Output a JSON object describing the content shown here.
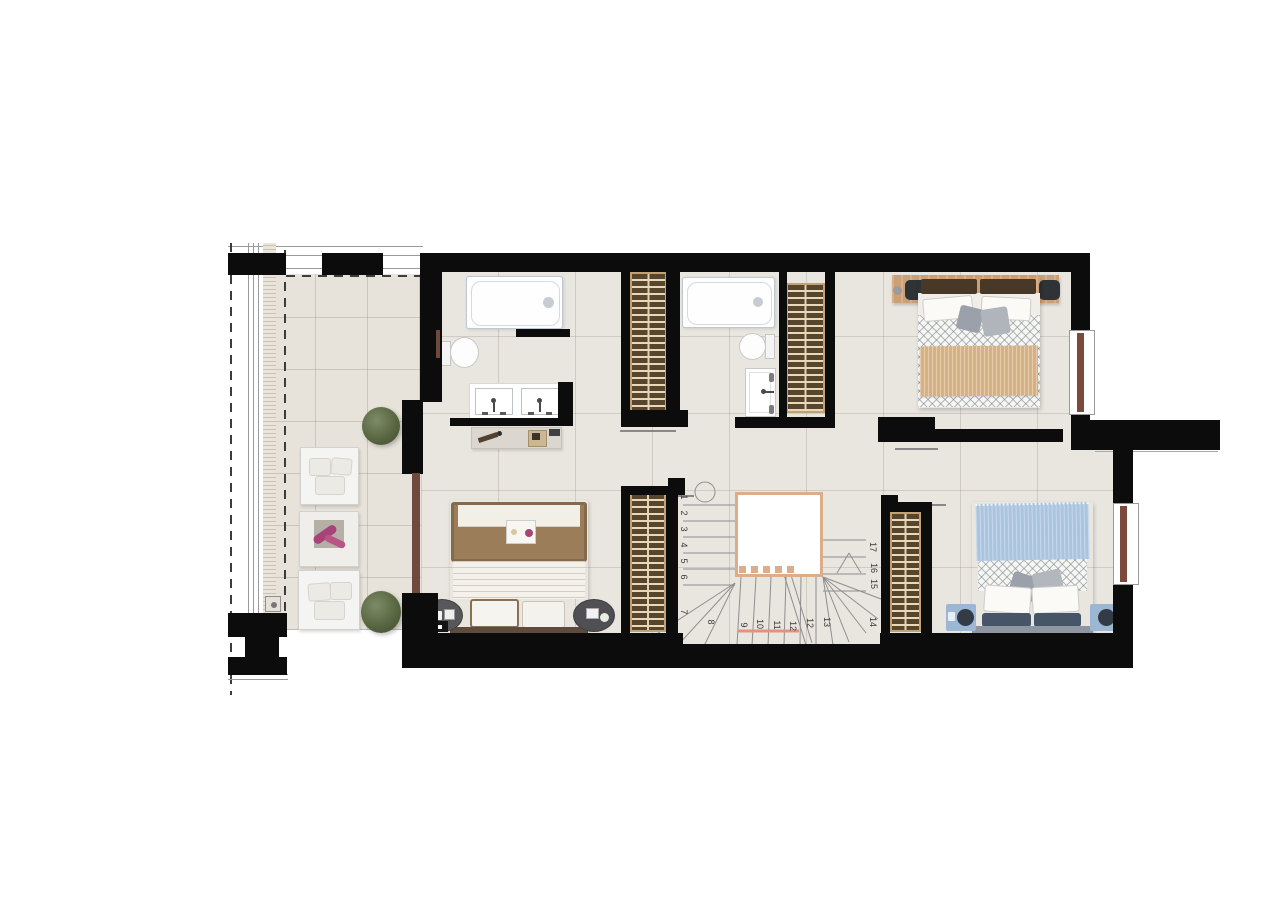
{
  "plan": {
    "type": "architectural-floor-plan",
    "stair_numbers": [
      {
        "label": "1",
        "x": 684,
        "y": 497
      },
      {
        "label": "2",
        "x": 684,
        "y": 513
      },
      {
        "label": "3",
        "x": 684,
        "y": 529
      },
      {
        "label": "4",
        "x": 684,
        "y": 545
      },
      {
        "label": "5",
        "x": 684,
        "y": 561
      },
      {
        "label": "6",
        "x": 684,
        "y": 577
      },
      {
        "label": "7",
        "x": 684,
        "y": 612
      },
      {
        "label": "8",
        "x": 711,
        "y": 622
      },
      {
        "label": "9",
        "x": 744,
        "y": 625
      },
      {
        "label": "10",
        "x": 760,
        "y": 624
      },
      {
        "label": "11",
        "x": 777,
        "y": 625
      },
      {
        "label": "12",
        "x": 793,
        "y": 626
      },
      {
        "label": "12",
        "x": 810,
        "y": 623
      },
      {
        "label": "13",
        "x": 827,
        "y": 622
      },
      {
        "label": "14",
        "x": 873,
        "y": 622
      },
      {
        "label": "15",
        "x": 874,
        "y": 584
      },
      {
        "label": "16",
        "x": 874,
        "y": 568
      },
      {
        "label": "17",
        "x": 873,
        "y": 547
      }
    ],
    "colors": {
      "wall": "#0c0c0c",
      "floor": "#e9e6e0",
      "terrace_floor": "#e7e3db",
      "wardrobe": "#57452e",
      "wardrobe_line": "#ead9b8",
      "wood": "#cd9f74",
      "stair_line": "#8f8f8f",
      "cut_line": "#e2927e",
      "door_brown": "#6f4a3c",
      "window_brown": "#7c4a3a",
      "tan_blanket": "#d8b183",
      "blue_blanket": "#aac4e0",
      "navy_pillow": "#475569",
      "gray_pillow": "#9aa1aa",
      "pattern_line": "rgba(125,132,142,.55)"
    }
  }
}
